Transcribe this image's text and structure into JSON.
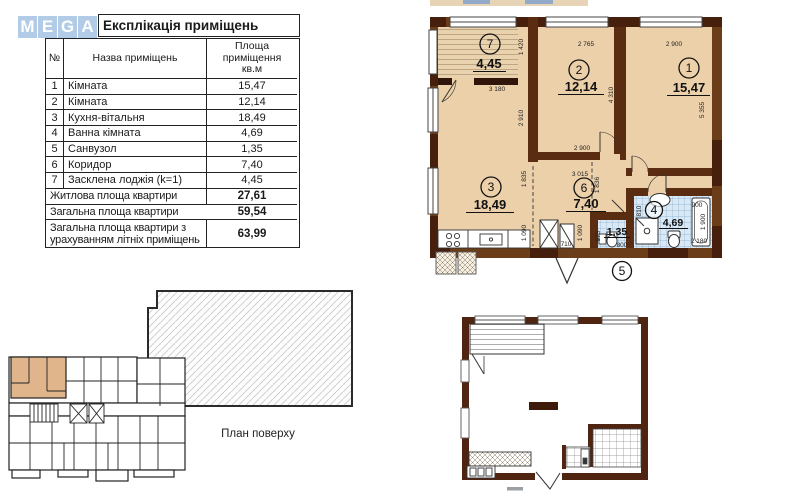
{
  "logo": {
    "letters": [
      "M",
      "E",
      "G",
      "A"
    ]
  },
  "table": {
    "title": "Експлікація приміщень",
    "col_num": "№",
    "col_name": "Назва приміщень",
    "col_area": "Площа\nприміщення\nкв.м",
    "rows": [
      {
        "num": "1",
        "name": "Кімната",
        "area": "15,47"
      },
      {
        "num": "2",
        "name": "Кімната",
        "area": "12,14"
      },
      {
        "num": "3",
        "name": "Кухня-вітальня",
        "area": "18,49"
      },
      {
        "num": "4",
        "name": "Ванна кімната",
        "area": "4,69"
      },
      {
        "num": "5",
        "name": "Санвузол",
        "area": "1,35"
      },
      {
        "num": "6",
        "name": "Коридор",
        "area": "7,40"
      },
      {
        "num": "7",
        "name": "Засклена лоджія (k=1)",
        "area": "4,45"
      }
    ],
    "totals": [
      {
        "name": "Житлова площа квартири",
        "area": "27,61"
      },
      {
        "name": "Загальна площа квартири",
        "area": "59,54"
      },
      {
        "name": "Загальна площа квартири з\nурахуванням літніх приміщень",
        "area": "63,99"
      }
    ]
  },
  "plan": {
    "rooms": {
      "r1": {
        "num": "1",
        "area": "15,47"
      },
      "r2": {
        "num": "2",
        "area": "12,14"
      },
      "r3": {
        "num": "3",
        "area": "18,49"
      },
      "r4": {
        "num": "4",
        "area": "4,69"
      },
      "r5": {
        "num": "5",
        "area": "1,35"
      },
      "r6": {
        "num": "6",
        "area": "7,40"
      },
      "r7": {
        "num": "7",
        "area": "4,45"
      }
    },
    "dims": {
      "d1420": "1 420",
      "d2765": "2 765",
      "d2900_top": "2 900",
      "d3180": "3 180",
      "d2910": "2 910",
      "d4310": "4 310",
      "d5355": "5 355",
      "d2900_mid": "2 900",
      "d3015": "3 015",
      "d1835": "1 835",
      "d1836": "1 836",
      "d1090_a": "1 090",
      "d1090_b": "1 090",
      "d710": "710",
      "d975": "975",
      "d810": "810",
      "d800": "800",
      "d900": "900",
      "d1900": "1 900",
      "d2180": "2 180"
    }
  },
  "floor_plan": {
    "caption": "План поверху"
  },
  "colors": {
    "wall_brown": "#6b3d18",
    "wall_dark": "#46200d",
    "partition": "#5a2c12",
    "room_beige": "#ecd0a9",
    "tile_blue": "#d9e8f4",
    "tile_line": "#86aecf",
    "highlight_tan": "#e0b58c",
    "logo_blue": "#aac7e5"
  }
}
